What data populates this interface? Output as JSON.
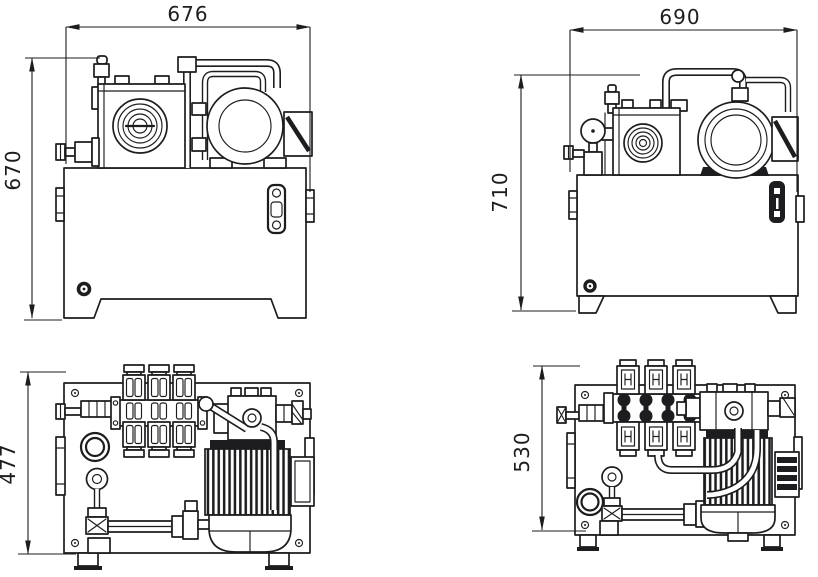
{
  "colors": {
    "line": "#1d1d1f",
    "background": "#ffffff"
  },
  "dimensions": {
    "front_left": {
      "width": "676",
      "height": "670"
    },
    "front_right": {
      "width": "690",
      "height": "710"
    },
    "plan_left": {
      "depth": "477"
    },
    "plan_right": {
      "depth": "530"
    }
  }
}
